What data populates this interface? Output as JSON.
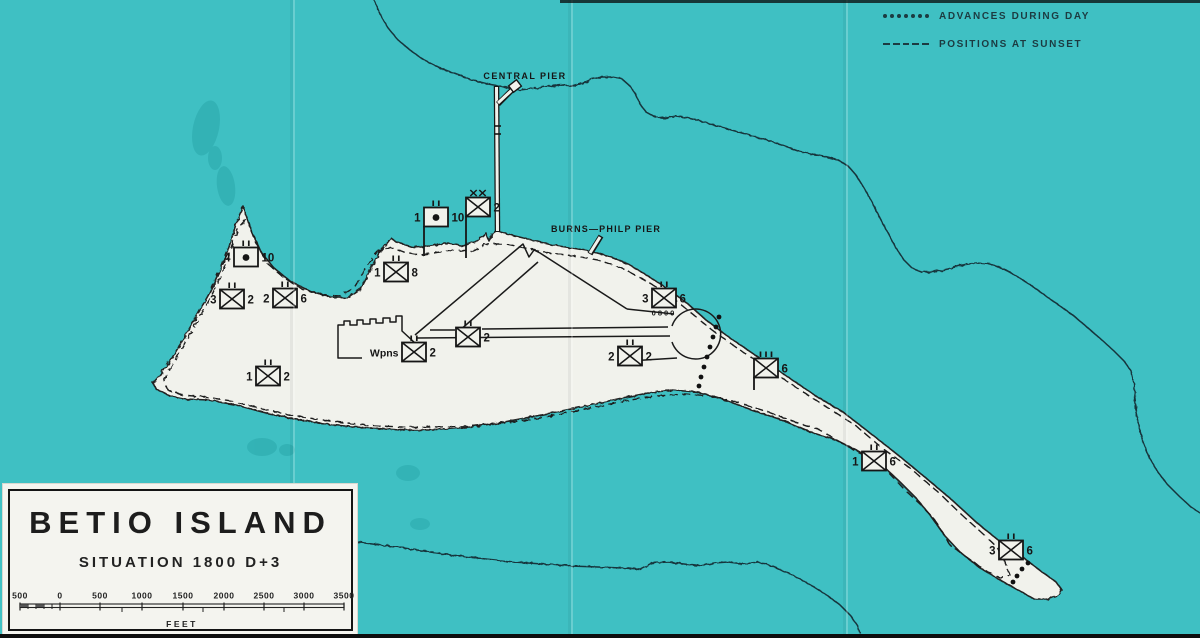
{
  "map": {
    "labels": {
      "central_pier": "CENTRAL PIER",
      "burns_philp_pier": "BURNS—PHILP PIER"
    },
    "legend": [
      {
        "symbol": "dotted-line",
        "label": "ADVANCES DURING DAY"
      },
      {
        "symbol": "dashed-line",
        "label": "POSITIONS AT SUNSET"
      }
    ],
    "units": [
      {
        "x": 436,
        "y": 217,
        "type": "artillery",
        "echelon": "II",
        "left": "1",
        "right": "10",
        "pole": 29
      },
      {
        "x": 478,
        "y": 207,
        "type": "infantry",
        "echelon": "XX",
        "left": "",
        "right": "2",
        "pole": 42
      },
      {
        "x": 246,
        "y": 257,
        "type": "artillery",
        "echelon": "II",
        "left": "4",
        "right": "10"
      },
      {
        "x": 232,
        "y": 299,
        "type": "infantry",
        "echelon": "II",
        "left": "3",
        "right": "2"
      },
      {
        "x": 285,
        "y": 298,
        "type": "infantry",
        "echelon": "II",
        "left": "2",
        "right": "6"
      },
      {
        "x": 396,
        "y": 272,
        "type": "infantry",
        "echelon": "II",
        "left": "1",
        "right": "8"
      },
      {
        "x": 414,
        "y": 352,
        "type": "infantry",
        "echelon": "II",
        "left": "Wpns",
        "right": "2"
      },
      {
        "x": 468,
        "y": 337,
        "type": "infantry",
        "echelon": "II",
        "left": "",
        "right": "2"
      },
      {
        "x": 664,
        "y": 298,
        "type": "infantry",
        "echelon": "II",
        "left": "3",
        "right": "6",
        "below": "0800"
      },
      {
        "x": 630,
        "y": 356,
        "type": "infantry",
        "echelon": "II",
        "left": "2",
        "right": "2"
      },
      {
        "x": 766,
        "y": 368,
        "type": "infantry",
        "echelon": "III",
        "left": "",
        "right": "6",
        "pole": 13
      },
      {
        "x": 874,
        "y": 461,
        "type": "infantry",
        "echelon": "II",
        "left": "1",
        "right": "6"
      },
      {
        "x": 1011,
        "y": 550,
        "type": "infantry",
        "echelon": "II",
        "left": "3",
        "right": "6"
      },
      {
        "x": 268,
        "y": 376,
        "type": "infantry",
        "echelon": "II",
        "left": "1",
        "right": "2"
      }
    ],
    "advances": {
      "airfield_east": [
        [
          719,
          317
        ],
        [
          716,
          327
        ],
        [
          713,
          337
        ],
        [
          710,
          347
        ],
        [
          707,
          357
        ],
        [
          704,
          367
        ],
        [
          701,
          377
        ],
        [
          699,
          386
        ]
      ],
      "east_tip": [
        [
          1028,
          563
        ],
        [
          1022,
          569
        ],
        [
          1017,
          576
        ],
        [
          1013,
          582
        ]
      ]
    }
  },
  "title_block": {
    "title": "BETIO ISLAND",
    "subtitle": "SITUATION 1800 D+3",
    "scale_labels": [
      "500",
      "0",
      "500",
      "1000",
      "1500",
      "2000",
      "2500",
      "3000",
      "3500"
    ],
    "scale_unit": "FEET"
  },
  "colors": {
    "sea": "#3fc0c3",
    "island": "#f1f2ec",
    "ink": "#161616",
    "reef_ink": "#17363c",
    "legend_ink": "#1c3b41"
  }
}
